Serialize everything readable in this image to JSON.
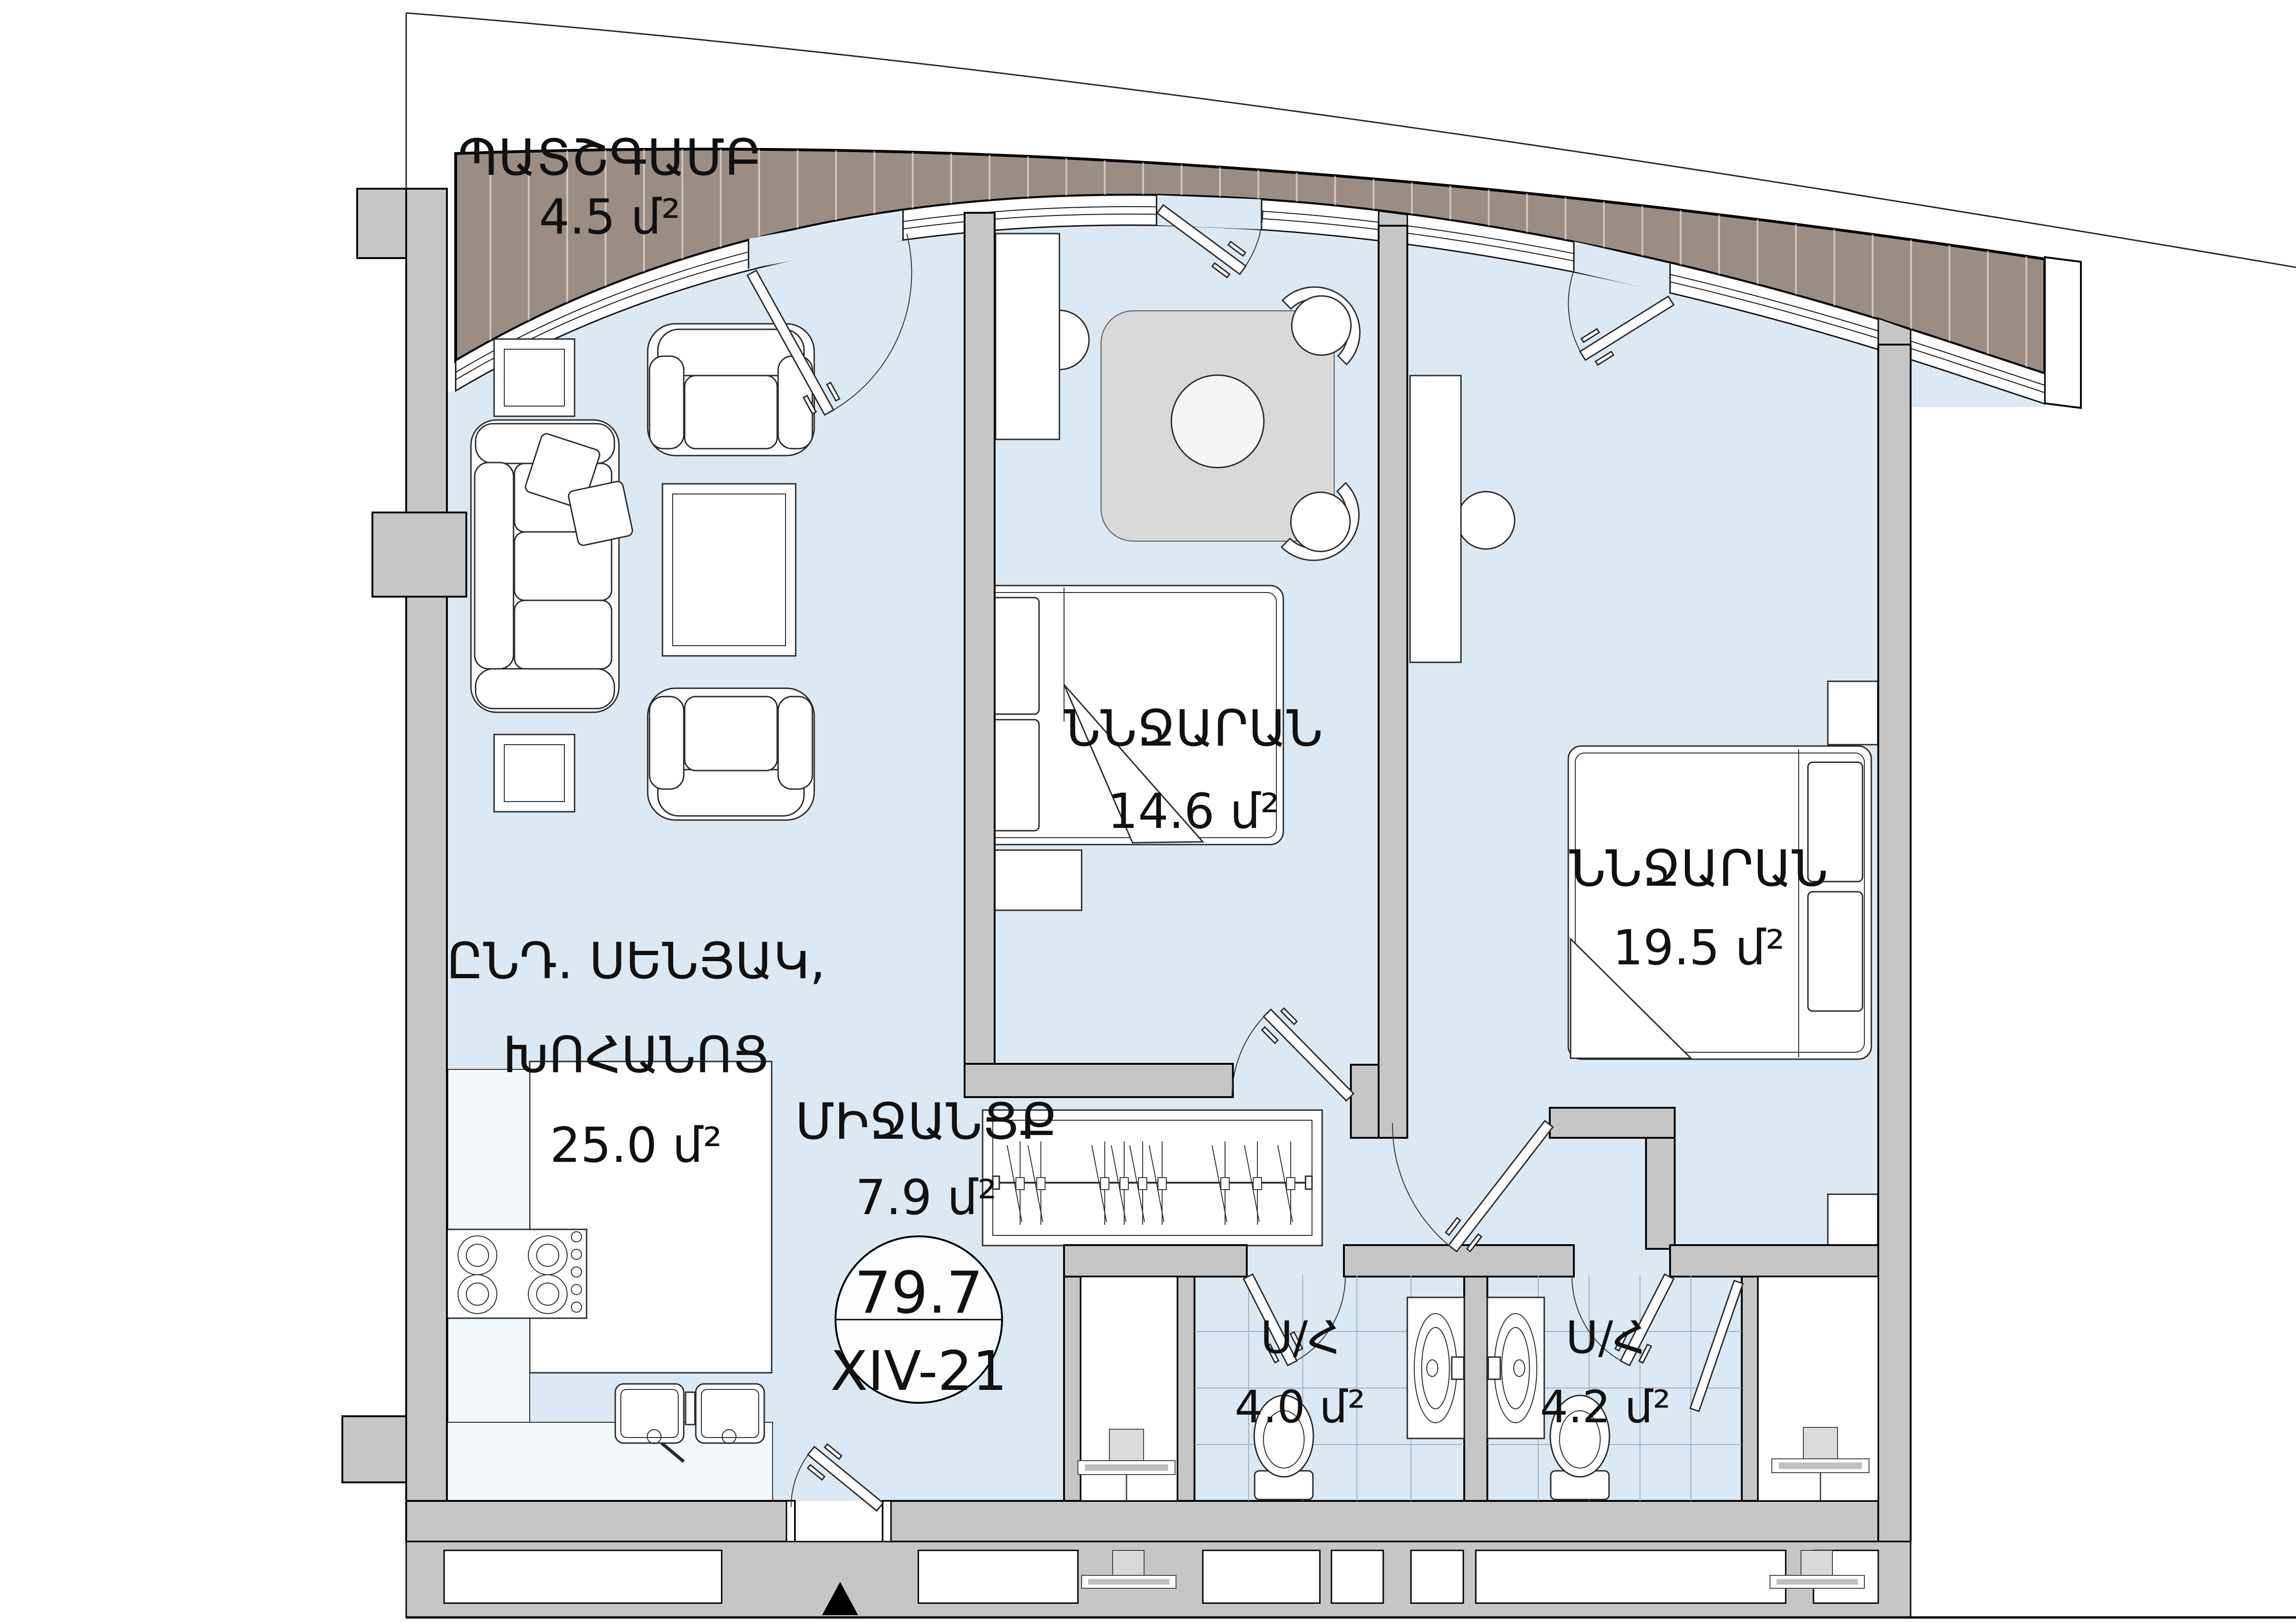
{
  "title": "Apartment floor plan",
  "colors": {
    "floor": "#dbe9f4",
    "wall": "#c6c6c6",
    "balcony_deck": "#9c8d82",
    "rug": "#d9d9d9",
    "line": "#111111"
  },
  "rooms": {
    "balcony": {
      "label": "ՊԱՏՇԳԱՄԲ",
      "area": "4.5 մ²"
    },
    "living_kitchen": {
      "label_line1": "ԸՆԴ. ՍԵՆՅԱԿ,",
      "label_line2": "ԽՈՀԱՆՈՑ",
      "area": "25.0 մ²"
    },
    "bedroom_1": {
      "label": "ՆՆՋԱՐԱՆ",
      "area": "14.6 մ²"
    },
    "bedroom_2": {
      "label": "ՆՆՋԱՐԱՆ",
      "area": "19.5 մ²"
    },
    "hallway": {
      "label": "ՄԻՋԱՆՑՔ",
      "area": "7.9 մ²"
    },
    "bathroom_1": {
      "label": "Ս/Հ",
      "area": "4.0 մ²"
    },
    "bathroom_2": {
      "label": "Ս/Հ",
      "area": "4.2 մ²"
    }
  },
  "unit_badge": {
    "total_area": "79.7",
    "unit_number": "XIV-21"
  }
}
